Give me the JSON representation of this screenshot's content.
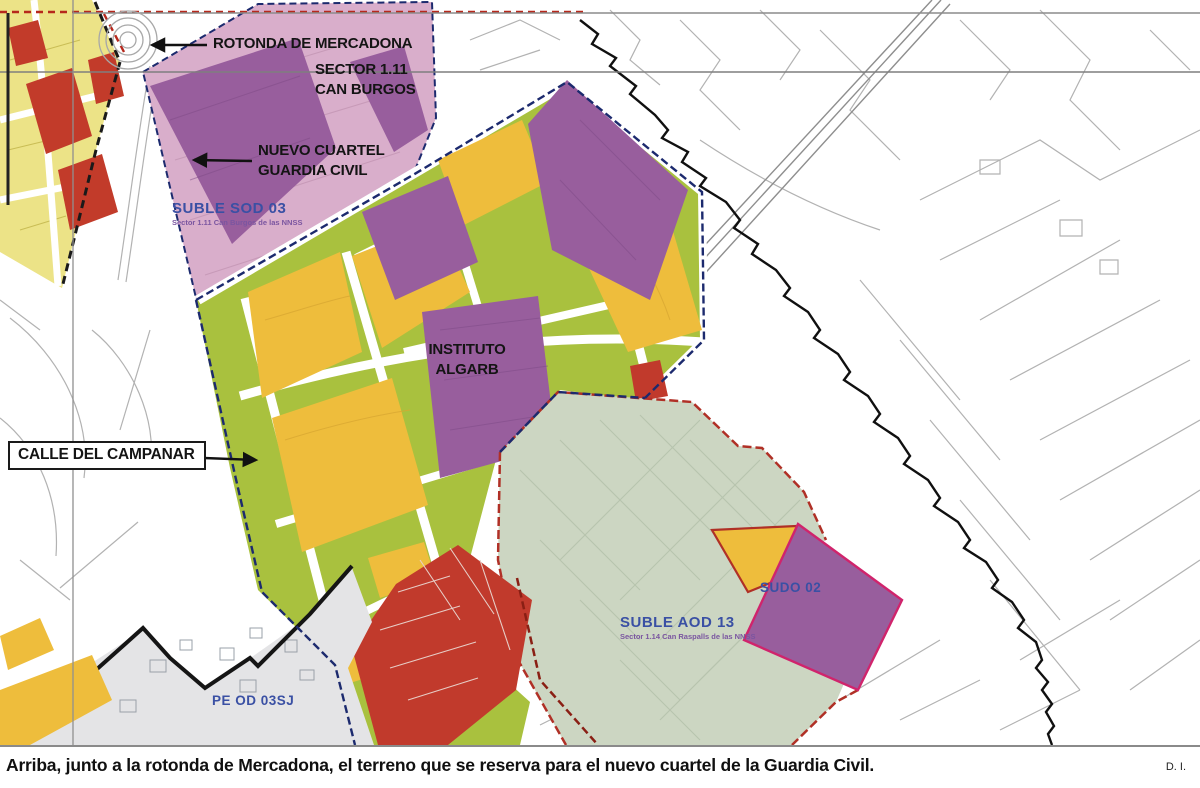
{
  "map": {
    "annotations": {
      "rotonda": "ROTONDA DE MERCADONA",
      "sector_line1": "SECTOR 1.11",
      "sector_line2": "CAN BURGOS",
      "cuartel_line1": "NUEVO CUARTEL",
      "cuartel_line2": "GUARDIA CIVIL",
      "instituto_line1": "INSTITUTO",
      "instituto_line2": "ALGARB",
      "campanar": "CALLE DEL CAMPANAR"
    },
    "zone_labels": {
      "suble_sod": {
        "title": "SUBLE SOD 03",
        "subtitle": "Sector 1.11 Can Burgos de las NNSS"
      },
      "suble_aod": {
        "title": "SUBLE AOD 13",
        "subtitle": "Sector 1.14 Can Raspalls de las NNSS"
      },
      "sudo": {
        "title": "SUDO 02"
      },
      "pe": {
        "title": "PE OD 03SJ"
      }
    },
    "colors": {
      "parcel_yellow": "#eebd3c",
      "parcel_green": "#a9c13e",
      "parcel_purple": "#985e9d",
      "sector_pink": "#d9aecb",
      "sector_sage": "#ccd6c2",
      "parcel_red": "#c13a2c",
      "urban_yellow": "#ece387",
      "pe_gray": "#e4e4e6",
      "boundary_navy": "#1c2a6e",
      "boundary_red": "#b03026",
      "boundary_magenta": "#d0246c",
      "label_blue": "#3a50a4"
    }
  },
  "caption": {
    "text": "Arriba, junto a la rotonda de Mercadona, el terreno que se reserva para el nuevo cuartel de la Guardia Civil.",
    "credit": "D. I."
  }
}
